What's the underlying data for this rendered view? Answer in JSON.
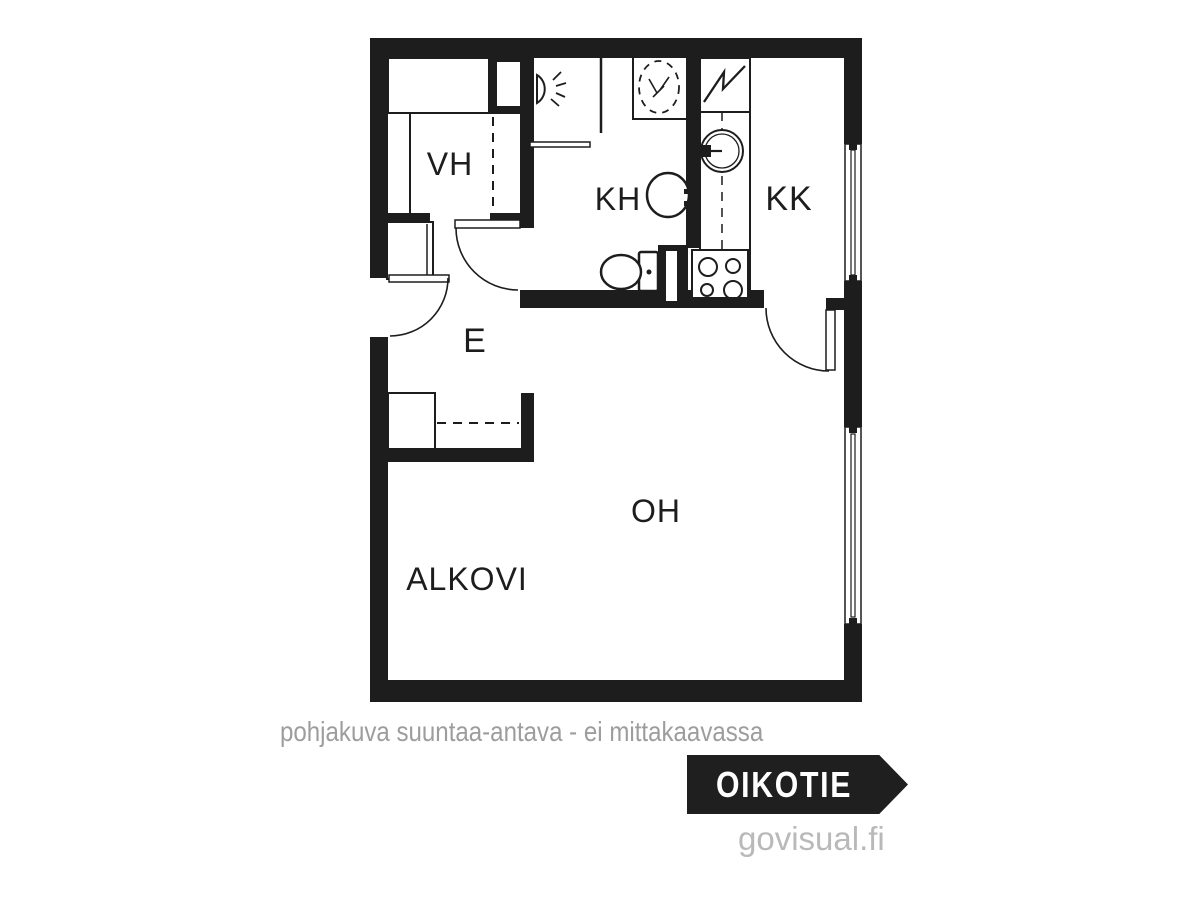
{
  "colors": {
    "ink": "#1d1d1d",
    "background": "#ffffff",
    "disclaimer_gray": "#9d9d9d",
    "credit_gray": "#b9b9b9",
    "badge_background": "#1f1f1f",
    "badge_text": "#ffffff"
  },
  "footer": {
    "disclaimer": "pohjakuva suuntaa-antava - ei mittakaavassa",
    "brand": "OIKOTIE",
    "credit": "govisual.fi"
  },
  "floorplan": {
    "rooms": [
      "VH",
      "KH",
      "KK",
      "E",
      "OH",
      "ALKOVI"
    ],
    "shapes": [
      {
        "kind": "rect",
        "name": "wall-top",
        "x": 370,
        "y": 38,
        "width": 492,
        "height": 20,
        "fill": "#1d1d1d"
      },
      {
        "kind": "rect",
        "name": "wall-left-upper",
        "x": 370,
        "y": 38,
        "width": 18,
        "height": 240,
        "fill": "#1d1d1d"
      },
      {
        "kind": "rect",
        "name": "wall-left-lower",
        "x": 370,
        "y": 337,
        "width": 18,
        "height": 365,
        "fill": "#1d1d1d"
      },
      {
        "kind": "rect",
        "name": "wall-bottom",
        "x": 370,
        "y": 680,
        "width": 492,
        "height": 22,
        "fill": "#1d1d1d"
      },
      {
        "kind": "rect",
        "name": "wall-right-upper",
        "x": 844,
        "y": 38,
        "width": 18,
        "height": 106,
        "fill": "#1d1d1d"
      },
      {
        "kind": "rect",
        "name": "wall-right-middle",
        "x": 844,
        "y": 281,
        "width": 18,
        "height": 146,
        "fill": "#1d1d1d"
      },
      {
        "kind": "rect",
        "name": "wall-right-lower",
        "x": 844,
        "y": 624,
        "width": 18,
        "height": 78,
        "fill": "#1d1d1d"
      },
      {
        "kind": "rect",
        "name": "wall-vh-kh",
        "x": 489,
        "y": 56,
        "width": 45,
        "height": 58,
        "fill": "#1d1d1d"
      },
      {
        "kind": "rect",
        "name": "duct-vh-kh",
        "x": 497,
        "y": 62,
        "width": 24,
        "height": 44,
        "fill": "#ffffff"
      },
      {
        "kind": "rect",
        "name": "wall-kh-left",
        "x": 520,
        "y": 56,
        "width": 14,
        "height": 168,
        "fill": "#1d1d1d"
      },
      {
        "kind": "rect",
        "name": "wall-vh-bottom-left",
        "x": 388,
        "y": 213,
        "width": 42,
        "height": 15,
        "fill": "#1d1d1d"
      },
      {
        "kind": "rect",
        "name": "wall-vh-bottom-right",
        "x": 490,
        "y": 213,
        "width": 44,
        "height": 15,
        "fill": "#1d1d1d"
      },
      {
        "kind": "rect",
        "name": "wall-kh-kk",
        "x": 686,
        "y": 56,
        "width": 14,
        "height": 192,
        "fill": "#1d1d1d"
      },
      {
        "kind": "rect",
        "name": "wall-kitchen-bottom",
        "x": 520,
        "y": 290,
        "width": 244,
        "height": 18,
        "fill": "#1d1d1d"
      },
      {
        "kind": "rect",
        "name": "duct-kh-kk",
        "x": 658,
        "y": 245,
        "width": 30,
        "height": 63,
        "fill": "#1d1d1d"
      },
      {
        "kind": "rect",
        "name": "duct-kh-kk-slot",
        "x": 666,
        "y": 251,
        "width": 11,
        "height": 50,
        "fill": "#ffffff"
      },
      {
        "kind": "rect",
        "name": "wall-kk-door-stub",
        "x": 826,
        "y": 298,
        "width": 18,
        "height": 12,
        "fill": "#1d1d1d"
      },
      {
        "kind": "rect",
        "name": "wall-e-closet-bottom",
        "x": 388,
        "y": 448,
        "width": 146,
        "height": 14,
        "fill": "#1d1d1d"
      },
      {
        "kind": "rect",
        "name": "wall-e-closet-stub",
        "x": 521,
        "y": 393,
        "width": 13,
        "height": 57,
        "fill": "#1d1d1d"
      },
      {
        "kind": "rect",
        "name": "window-kk-frame",
        "x": 845,
        "y": 144,
        "width": 16,
        "height": 137,
        "fill": "#ffffff",
        "stroke": "#1d1d1d",
        "stroke-width": 1.5
      },
      {
        "kind": "rect",
        "name": "window-kk-mullion",
        "x": 851,
        "y": 150,
        "width": 4,
        "height": 125,
        "fill": "#ffffff",
        "stroke": "#1d1d1d",
        "stroke-width": 1.2
      },
      {
        "kind": "rect",
        "name": "window-kk-nub-top",
        "x": 849,
        "y": 144,
        "width": 8,
        "height": 6,
        "fill": "#1d1d1d"
      },
      {
        "kind": "rect",
        "name": "window-kk-nub-bottom",
        "x": 849,
        "y": 275,
        "width": 8,
        "height": 6,
        "fill": "#1d1d1d"
      },
      {
        "kind": "rect",
        "name": "window-oh-frame",
        "x": 845,
        "y": 427,
        "width": 16,
        "height": 197,
        "fill": "#ffffff",
        "stroke": "#1d1d1d",
        "stroke-width": 1.5
      },
      {
        "kind": "rect",
        "name": "window-oh-mullion",
        "x": 851,
        "y": 434,
        "width": 4,
        "height": 183,
        "fill": "#ffffff",
        "stroke": "#1d1d1d",
        "stroke-width": 1.2
      },
      {
        "kind": "rect",
        "name": "window-oh-nub-top",
        "x": 849,
        "y": 427,
        "width": 8,
        "height": 6,
        "fill": "#1d1d1d"
      },
      {
        "kind": "rect",
        "name": "window-oh-nub-bottom",
        "x": 849,
        "y": 618,
        "width": 8,
        "height": 6,
        "fill": "#1d1d1d"
      },
      {
        "kind": "rect",
        "name": "cabinet-vh-top",
        "x": 388,
        "y": 58,
        "width": 101,
        "height": 55,
        "fill": "#ffffff",
        "stroke": "#1d1d1d",
        "stroke-width": 2
      },
      {
        "kind": "line",
        "name": "cabinet-vh-divider",
        "x1": 410,
        "y1": 113,
        "x2": 410,
        "y2": 213,
        "stroke": "#1d1d1d",
        "stroke-width": 2
      },
      {
        "kind": "line",
        "name": "wardrobe-vh-front-dashed",
        "x1": 493,
        "y1": 117,
        "x2": 493,
        "y2": 211,
        "stroke": "#1d1d1d",
        "stroke-width": 2,
        "stroke-dasharray": "9,7"
      },
      {
        "kind": "rect",
        "name": "cabinet-e-upper",
        "x": 387,
        "y": 222,
        "width": 46,
        "height": 57,
        "fill": "#ffffff",
        "stroke": "#1d1d1d",
        "stroke-width": 2
      },
      {
        "kind": "line",
        "name": "cabinet-e-upper-front",
        "x1": 427,
        "y1": 224,
        "x2": 427,
        "y2": 277,
        "stroke": "#1d1d1d",
        "stroke-width": 1.5
      },
      {
        "kind": "rect",
        "name": "closet-e-box",
        "x": 388,
        "y": 393,
        "width": 47,
        "height": 56,
        "fill": "#ffffff",
        "stroke": "#1d1d1d",
        "stroke-width": 2
      },
      {
        "kind": "line",
        "name": "closet-e-rail-dashed",
        "x1": 437,
        "y1": 423,
        "x2": 519,
        "y2": 423,
        "stroke": "#1d1d1d",
        "stroke-width": 2,
        "stroke-dasharray": "9,7"
      },
      {
        "kind": "line",
        "name": "kh-partition",
        "x1": 601,
        "y1": 58,
        "x2": 601,
        "y2": 133,
        "stroke": "#1d1d1d",
        "stroke-width": 2.5
      },
      {
        "kind": "rect",
        "name": "kh-towel-rail",
        "x": 530,
        "y": 142,
        "width": 60,
        "height": 5,
        "fill": "#ffffff",
        "stroke": "#1d1d1d",
        "stroke-width": 1.5
      },
      {
        "kind": "path",
        "name": "shower-head-icon",
        "d": "M537,75 A15,16 0 0 1 537,103 L537,75 Z",
        "fill": "#ffffff",
        "stroke": "#1d1d1d",
        "stroke-width": 2
      },
      {
        "kind": "line",
        "name": "shower-ray-1",
        "x1": 553,
        "y1": 80,
        "x2": 561,
        "y2": 72,
        "stroke": "#1d1d1d",
        "stroke-width": 1.8
      },
      {
        "kind": "line",
        "name": "shower-ray-2",
        "x1": 556,
        "y1": 86,
        "x2": 566,
        "y2": 83,
        "stroke": "#1d1d1d",
        "stroke-width": 1.8
      },
      {
        "kind": "line",
        "name": "shower-ray-3",
        "x1": 556,
        "y1": 93,
        "x2": 565,
        "y2": 97,
        "stroke": "#1d1d1d",
        "stroke-width": 1.8
      },
      {
        "kind": "line",
        "name": "shower-ray-4",
        "x1": 551,
        "y1": 99,
        "x2": 559,
        "y2": 106,
        "stroke": "#1d1d1d",
        "stroke-width": 1.8
      },
      {
        "kind": "rect",
        "name": "washing-machine-icon",
        "x": 633,
        "y": 57,
        "width": 54,
        "height": 62,
        "fill": "#ffffff",
        "stroke": "#1d1d1d",
        "stroke-width": 2
      },
      {
        "kind": "ellipse",
        "name": "washing-machine-drum",
        "cx": 659,
        "cy": 87,
        "rx": 20,
        "ry": 26,
        "fill": "none",
        "stroke": "#1d1d1d",
        "stroke-width": 1.8,
        "stroke-dasharray": "7,6"
      },
      {
        "kind": "line",
        "name": "washer-mark-1",
        "x1": 649,
        "y1": 79,
        "x2": 657,
        "y2": 93,
        "stroke": "#1d1d1d",
        "stroke-width": 1.6
      },
      {
        "kind": "line",
        "name": "washer-mark-2",
        "x1": 669,
        "y1": 77,
        "x2": 660,
        "y2": 90,
        "stroke": "#1d1d1d",
        "stroke-width": 1.6
      },
      {
        "kind": "line",
        "name": "washer-mark-3",
        "x1": 653,
        "y1": 97,
        "x2": 664,
        "y2": 86,
        "stroke": "#1d1d1d",
        "stroke-width": 1.6
      },
      {
        "kind": "ellipse",
        "name": "kh-sink-icon",
        "cx": 668,
        "cy": 195,
        "rx": 21,
        "ry": 22,
        "fill": "#ffffff",
        "stroke": "#1d1d1d",
        "stroke-width": 2.5
      },
      {
        "kind": "rect",
        "name": "kh-tap-top",
        "x": 684,
        "y": 189,
        "width": 15,
        "height": 5,
        "fill": "#1d1d1d"
      },
      {
        "kind": "rect",
        "name": "kh-tap-bottom",
        "x": 684,
        "y": 201,
        "width": 15,
        "height": 5,
        "fill": "#1d1d1d"
      },
      {
        "kind": "rect",
        "name": "kh-tap-base",
        "x": 695,
        "y": 187,
        "width": 5,
        "height": 21,
        "fill": "#1d1d1d"
      },
      {
        "kind": "rect",
        "name": "toilet-tank",
        "x": 639,
        "y": 252,
        "width": 19,
        "height": 39,
        "rx": 2,
        "fill": "#ffffff",
        "stroke": "#1d1d1d",
        "stroke-width": 2.5
      },
      {
        "kind": "ellipse",
        "name": "toilet-bowl-icon",
        "cx": 621,
        "cy": 272,
        "rx": 20,
        "ry": 17,
        "fill": "#ffffff",
        "stroke": "#1d1d1d",
        "stroke-width": 2.5
      },
      {
        "kind": "circle",
        "name": "toilet-button",
        "cx": 649,
        "cy": 272,
        "r": 2.5,
        "fill": "#1d1d1d"
      },
      {
        "kind": "rect",
        "name": "electric-panel",
        "x": 700,
        "y": 58,
        "width": 50,
        "height": 54,
        "fill": "#ffffff",
        "stroke": "#1d1d1d",
        "stroke-width": 2
      },
      {
        "kind": "polyline",
        "name": "electric-bolt-icon",
        "points": "704,102 724,72 723,89 745,66",
        "fill": "none",
        "stroke": "#1d1d1d",
        "stroke-width": 2.3
      },
      {
        "kind": "rect",
        "name": "kitchen-counter",
        "x": 700,
        "y": 112,
        "width": 50,
        "height": 184,
        "fill": "#ffffff",
        "stroke": "#1d1d1d",
        "stroke-width": 2
      },
      {
        "kind": "line",
        "name": "kitchen-counter-dashed",
        "x1": 722,
        "y1": 112,
        "x2": 722,
        "y2": 296,
        "stroke": "#1d1d1d",
        "stroke-width": 1.5,
        "stroke-dasharray": "9,7"
      },
      {
        "kind": "circle",
        "name": "kk-sink-outer",
        "cx": 722,
        "cy": 151,
        "r": 21,
        "fill": "#ffffff",
        "stroke": "#1d1d1d",
        "stroke-width": 2
      },
      {
        "kind": "circle",
        "name": "kk-sink-inner",
        "cx": 722,
        "cy": 151,
        "r": 17,
        "fill": "none",
        "stroke": "#1d1d1d",
        "stroke-width": 1.3
      },
      {
        "kind": "rect",
        "name": "kk-tap-body",
        "x": 699,
        "y": 145,
        "width": 12,
        "height": 12,
        "fill": "#1d1d1d"
      },
      {
        "kind": "rect",
        "name": "kk-tap-nub-top",
        "x": 694,
        "y": 146,
        "width": 5,
        "height": 4,
        "fill": "#1d1d1d"
      },
      {
        "kind": "rect",
        "name": "kk-tap-nub-bottom",
        "x": 694,
        "y": 153,
        "width": 5,
        "height": 4,
        "fill": "#1d1d1d"
      },
      {
        "kind": "line",
        "name": "kk-tap-stem",
        "x1": 711,
        "y1": 151,
        "x2": 722,
        "y2": 151,
        "stroke": "#1d1d1d",
        "stroke-width": 2.2
      },
      {
        "kind": "rect",
        "name": "stove-icon",
        "x": 692,
        "y": 250,
        "width": 56,
        "height": 48,
        "fill": "#ffffff",
        "stroke": "#1d1d1d",
        "stroke-width": 2
      },
      {
        "kind": "circle",
        "name": "stove-burner-1",
        "cx": 708,
        "cy": 267,
        "r": 9,
        "fill": "none",
        "stroke": "#1d1d1d",
        "stroke-width": 2
      },
      {
        "kind": "circle",
        "name": "stove-burner-2",
        "cx": 733,
        "cy": 266,
        "r": 7,
        "fill": "none",
        "stroke": "#1d1d1d",
        "stroke-width": 2
      },
      {
        "kind": "circle",
        "name": "stove-burner-3",
        "cx": 707,
        "cy": 290,
        "r": 6,
        "fill": "none",
        "stroke": "#1d1d1d",
        "stroke-width": 2
      },
      {
        "kind": "circle",
        "name": "stove-burner-4",
        "cx": 733,
        "cy": 290,
        "r": 9,
        "fill": "none",
        "stroke": "#1d1d1d",
        "stroke-width": 2
      },
      {
        "kind": "rect",
        "name": "entry-door-leaf",
        "x": 389,
        "y": 275,
        "width": 60,
        "height": 7,
        "fill": "#ffffff",
        "stroke": "#1d1d1d",
        "stroke-width": 1.5
      },
      {
        "kind": "path",
        "name": "entry-door-arc",
        "d": "M448,278 A58,58 0 0 1 390,336",
        "fill": "none",
        "stroke": "#1d1d1d",
        "stroke-width": 1.6
      },
      {
        "kind": "rect",
        "name": "kh-door-leaf",
        "x": 455,
        "y": 220,
        "width": 65,
        "height": 8,
        "fill": "#ffffff",
        "stroke": "#1d1d1d",
        "stroke-width": 1.5
      },
      {
        "kind": "path",
        "name": "kh-door-arc",
        "d": "M456,228 A62,62 0 0 0 518,290",
        "fill": "none",
        "stroke": "#1d1d1d",
        "stroke-width": 1.6
      },
      {
        "kind": "rect",
        "name": "kk-door-leaf",
        "x": 826,
        "y": 310,
        "width": 9,
        "height": 60,
        "fill": "#ffffff",
        "stroke": "#1d1d1d",
        "stroke-width": 1.5
      },
      {
        "kind": "path",
        "name": "kk-door-arc",
        "d": "M766,308 A63,63 0 0 0 829,371",
        "fill": "none",
        "stroke": "#1d1d1d",
        "stroke-width": 1.6
      },
      {
        "kind": "text",
        "name": "room-label-vh",
        "text": "VH",
        "x": 450,
        "y": 175,
        "font-size": 32,
        "text-anchor": "middle"
      },
      {
        "kind": "text",
        "name": "room-label-kh",
        "text": "KH",
        "x": 618,
        "y": 210,
        "font-size": 32,
        "text-anchor": "middle"
      },
      {
        "kind": "text",
        "name": "room-label-kk",
        "text": "KK",
        "x": 789,
        "y": 210,
        "font-size": 34,
        "text-anchor": "middle"
      },
      {
        "kind": "text",
        "name": "room-label-e",
        "text": "E",
        "x": 475,
        "y": 352,
        "font-size": 34,
        "text-anchor": "middle"
      },
      {
        "kind": "text",
        "name": "room-label-oh",
        "text": "OH",
        "x": 656,
        "y": 522,
        "font-size": 32,
        "text-anchor": "middle"
      },
      {
        "kind": "text",
        "name": "room-label-alkovi",
        "text": "ALKOVI",
        "x": 467,
        "y": 590,
        "font-size": 32,
        "text-anchor": "middle"
      }
    ]
  }
}
